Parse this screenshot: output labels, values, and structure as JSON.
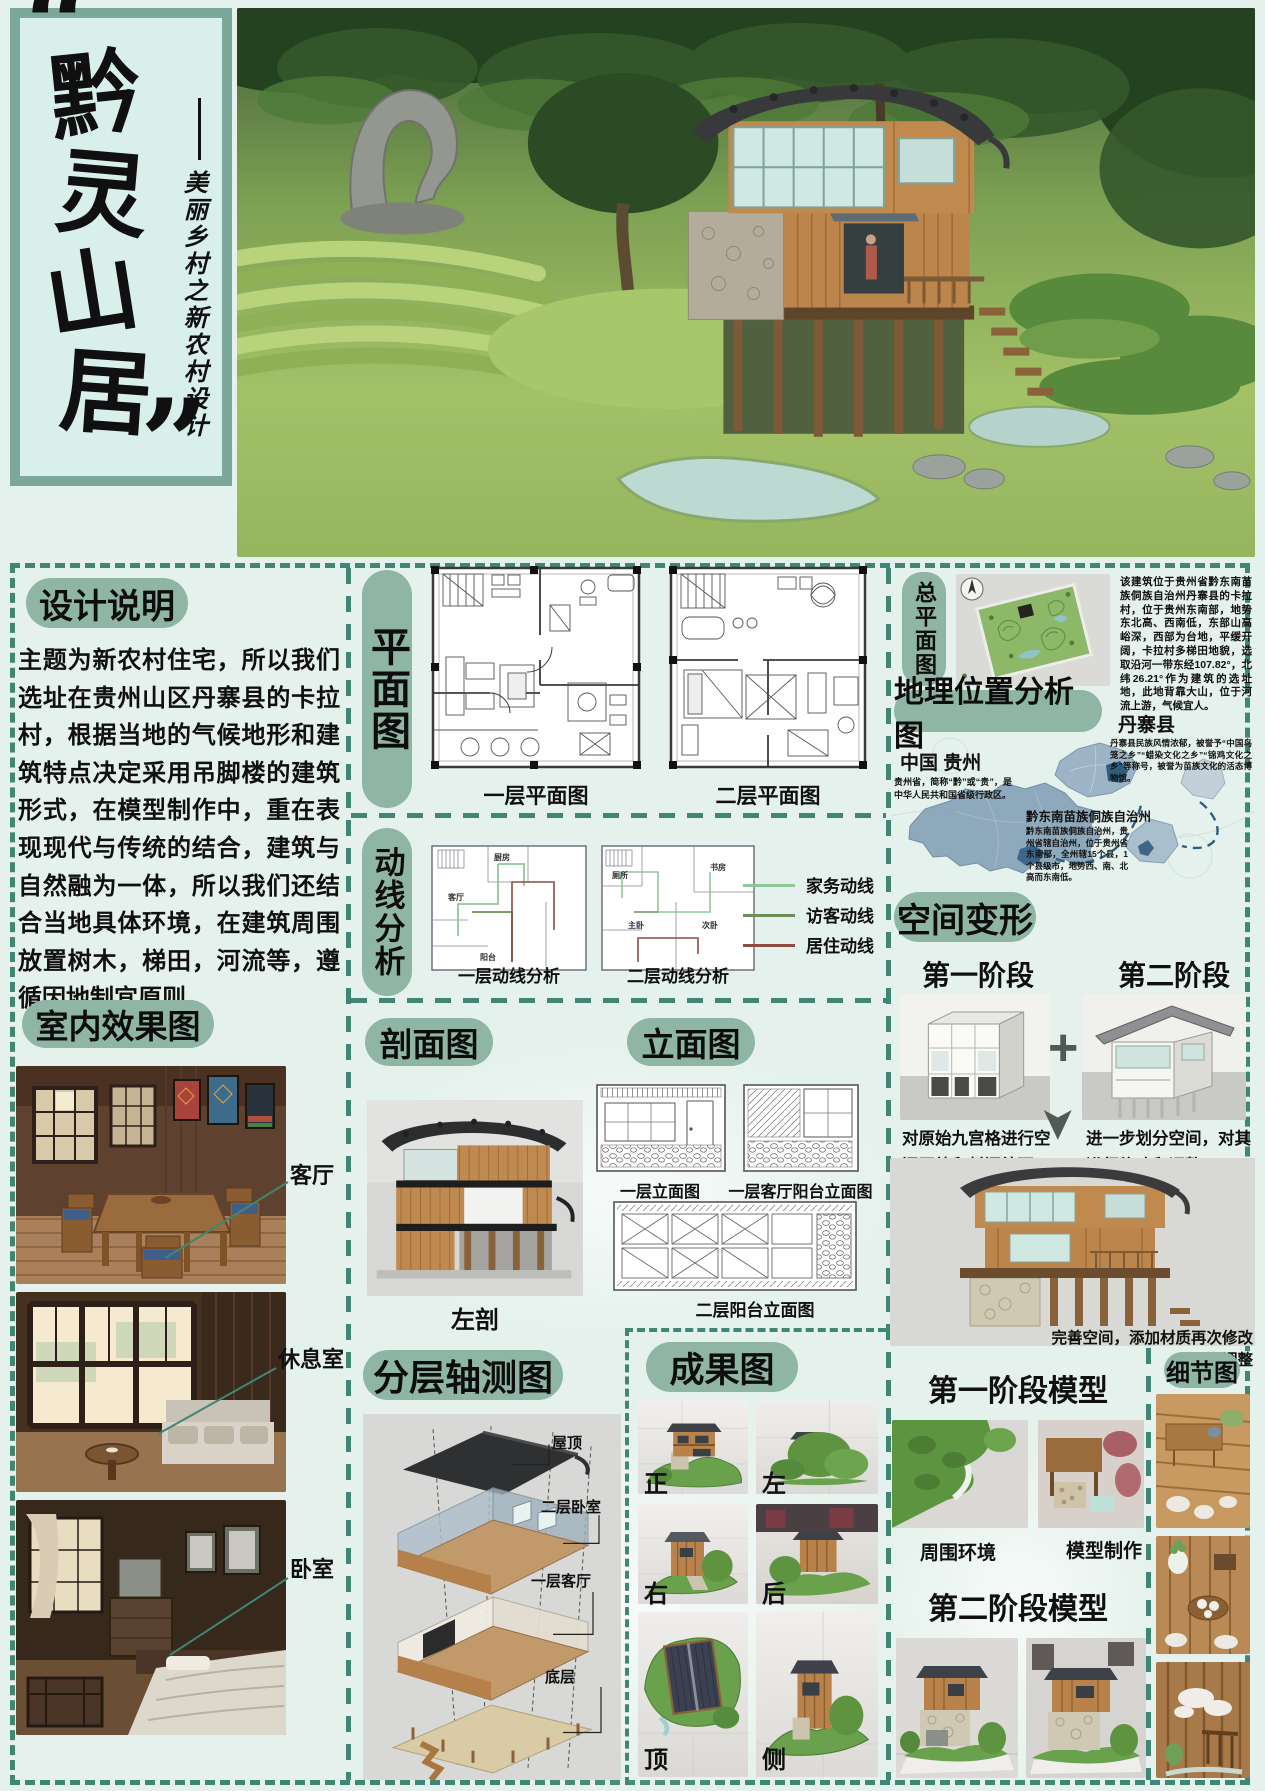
{
  "colors": {
    "accent_teal": "#3f8674",
    "pill_green": "#8fb5a4",
    "panel_bg": "#d9efec",
    "panel_border": "#7ba89a"
  },
  "title_panel": {
    "open_quote": "“",
    "close_quote": "”",
    "title_chars": [
      "黔",
      "灵",
      "山",
      "居"
    ],
    "subtitle": "美丽乡村之新农村设计"
  },
  "design_notes": {
    "heading": "设计说明",
    "body": "主题为新农村住宅，所以我们选址在贵州山区丹寨县的卡拉村，根据当地的气候地形和建筑特点决定采用吊脚楼的建筑形式，在模型制作中，重在表现现代与传统的结合，建筑与自然融为一体，所以我们还结合当地具体环境，在建筑周围放置树木，梯田，河流等，遵循因地制宜原则。"
  },
  "floor_plans": {
    "heading": "平面图",
    "plan1_label": "一层平面图",
    "plan2_label": "二层平面图"
  },
  "circulation": {
    "heading": "动线分析",
    "plan1_label": "一层动线分析",
    "plan2_label": "二层动线分析",
    "rooms_f1": [
      "厨房",
      "客厅",
      "阳台"
    ],
    "rooms_f2": [
      "厕所",
      "书房",
      "主卧",
      "次卧"
    ],
    "legend": [
      {
        "label": "家务动线",
        "color": "#8fc79c"
      },
      {
        "label": "访客动线",
        "color": "#6f8d58"
      },
      {
        "label": "居住动线",
        "color": "#8e4b40"
      }
    ]
  },
  "site_plan": {
    "heading": "总平面图",
    "description": "该建筑位于贵州省黔东南苗族侗族自治州丹寨县的卡拉村，位于贵州东南部，地势东北高、西南低，东部山高峪深，西部为台地，平缓开阔，卡拉村多梯田地貌，选取沿河一带东经107.82°，北纬26.21°作为建筑的选址地，此地背靠大山，位于河流上游，气候宜人。"
  },
  "geo": {
    "heading": "地理位置分析图",
    "guizhou_title": "中国 贵州",
    "guizhou_desc": "贵州省，简称“黔”或“贵”，是中华人民共和国省级行政区。",
    "danzhai_title": "丹寨县",
    "danzhai_desc": "丹寨县民族风情浓郁，被誉予“中国鸟笼之乡”“蜡染文化之乡”“锦鸡文化之乡”等称号，被誉为苗族文化的活态博物馆。",
    "qdn_title": "黔东南苗族侗族自治州",
    "qdn_desc": "黔东南苗族侗族自治州，贵州省辖自治州，位于贵州省东南部，全州辖15个县，1个县级市，地势西、南、北高而东南低。"
  },
  "space_transform": {
    "heading": "空间变形",
    "stage1_label": "第一阶段",
    "stage2_label": "第二阶段",
    "plus_glyph": "+",
    "arrow_glyph": "➤",
    "stage1_caption": "对原始九宫格进行空间开放和封闭处理",
    "stage2_caption": "进一步划分空间，对其进行修改和调整",
    "final_caption": "完善空间，添加材质再次修改和调整"
  },
  "interior": {
    "heading": "室内效果图",
    "labels": [
      "客厅",
      "休息室",
      "卧室"
    ]
  },
  "section_view": {
    "heading": "剖面图",
    "label": "左剖"
  },
  "elevations": {
    "heading": "立面图",
    "labels": [
      "一层立面图",
      "一层客厅阳台立面图",
      "二层阳台立面图"
    ]
  },
  "axonometric": {
    "heading": "分层轴测图",
    "labels": [
      "屋顶",
      "二层卧室",
      "一层客厅",
      "底层"
    ]
  },
  "results": {
    "heading": "成果图",
    "labels": [
      "正",
      "左",
      "右",
      "后",
      "顶",
      "侧"
    ]
  },
  "models": {
    "stage1_heading": "第一阶段模型",
    "env_label": "周围环境",
    "making_label": "模型制作",
    "stage2_heading": "第二阶段模型",
    "details_heading": "细节图"
  }
}
